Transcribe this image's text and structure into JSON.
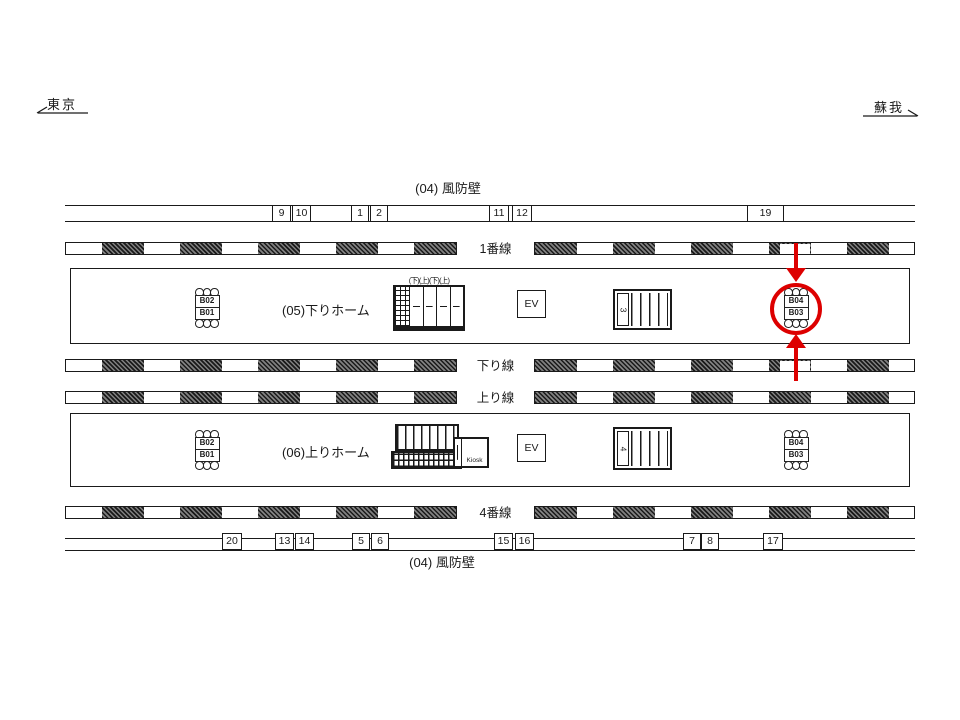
{
  "directions": {
    "left_label": "東京",
    "right_label": "蘇我"
  },
  "windbreak_wall_top": {
    "label": "(04) 風防壁",
    "boxes": [
      "9",
      "10",
      "1",
      "2",
      "11",
      "12",
      "19"
    ]
  },
  "windbreak_wall_bottom": {
    "label": "(04) 風防壁",
    "boxes": [
      "20",
      "13",
      "14",
      "5",
      "6",
      "15",
      "16",
      "7",
      "8",
      "17"
    ]
  },
  "tracks": {
    "track1": "1番線",
    "down_line": "下り線",
    "up_line": "上り線",
    "track4": "4番線"
  },
  "platforms": {
    "upper": {
      "label": "(05)下りホーム"
    },
    "lower": {
      "label": "(06)上りホーム"
    }
  },
  "benches": {
    "upper_left": {
      "top": "B02",
      "bottom": "B01"
    },
    "upper_right": {
      "top": "B04",
      "bottom": "B03"
    },
    "lower_left": {
      "top": "B02",
      "bottom": "B01"
    },
    "lower_right": {
      "top": "B04",
      "bottom": "B03"
    }
  },
  "elevator_label": "EV",
  "escalator_head_labels": "(下)(上)(下)(上)",
  "stair_numbers": {
    "upper": "3",
    "lower": "4"
  },
  "kiosk_label": "Kiosk",
  "highlight_color": "#dd0000"
}
